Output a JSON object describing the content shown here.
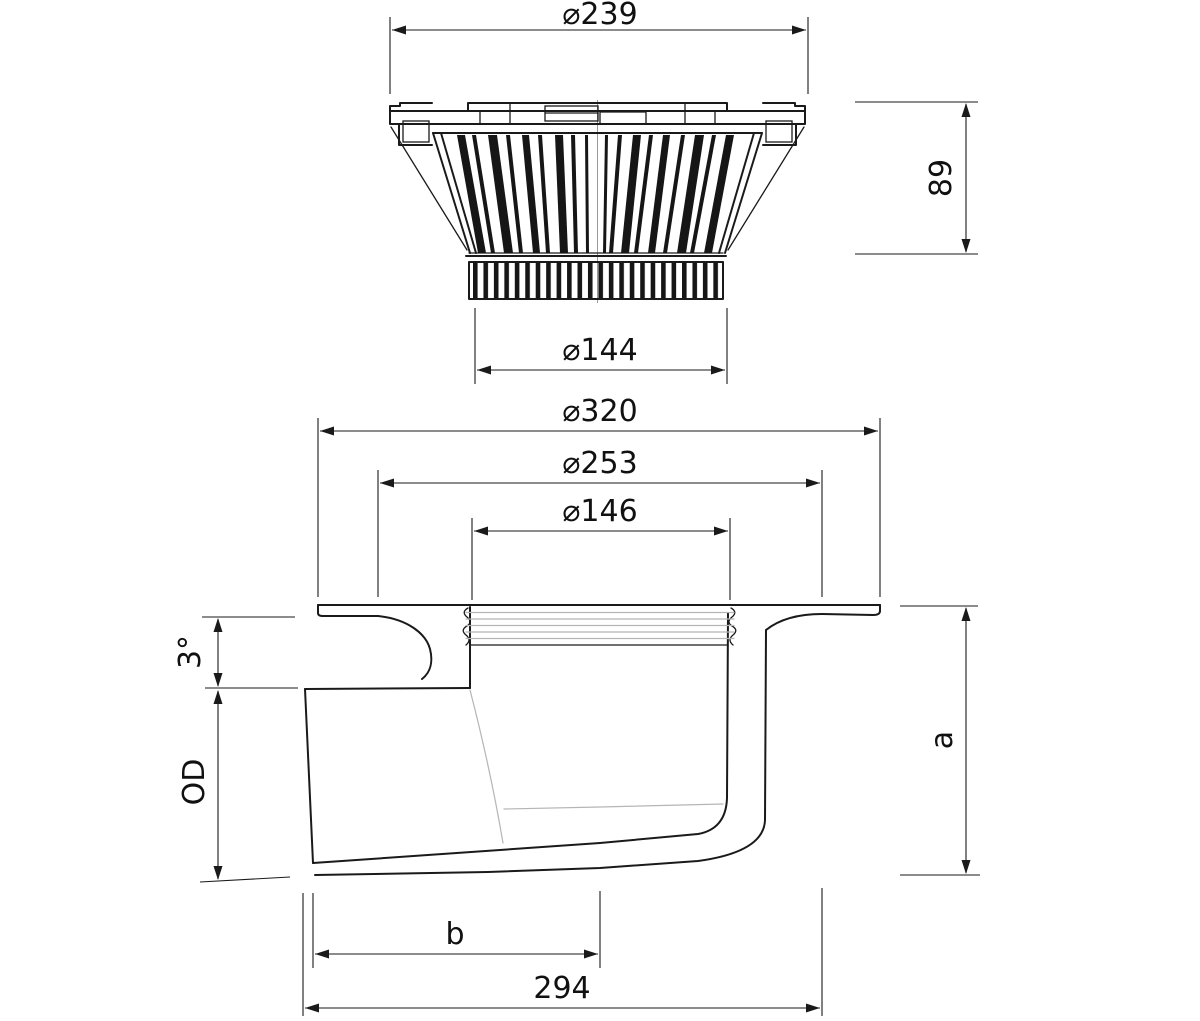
{
  "drawing": {
    "type": "technical-drawing",
    "views": {
      "strainer_top": {
        "name": "dome strainer elevation",
        "dims": {
          "outer_dia": "⌀239",
          "height": "89",
          "spigot_dia": "⌀144"
        }
      },
      "body_section": {
        "name": "drain body cross-section",
        "dims": {
          "flange_dia": "⌀320",
          "collar_dia": "⌀253",
          "throat_dia": "⌀146",
          "slope_angle": "3°",
          "outlet_dia": "OD",
          "height": "a",
          "outlet_to_axis": "b",
          "overall_length": "294"
        }
      }
    },
    "colors": {
      "line": "#1a1a1a",
      "hidden_line": "#b5b5b5",
      "background": "#ffffff"
    }
  }
}
